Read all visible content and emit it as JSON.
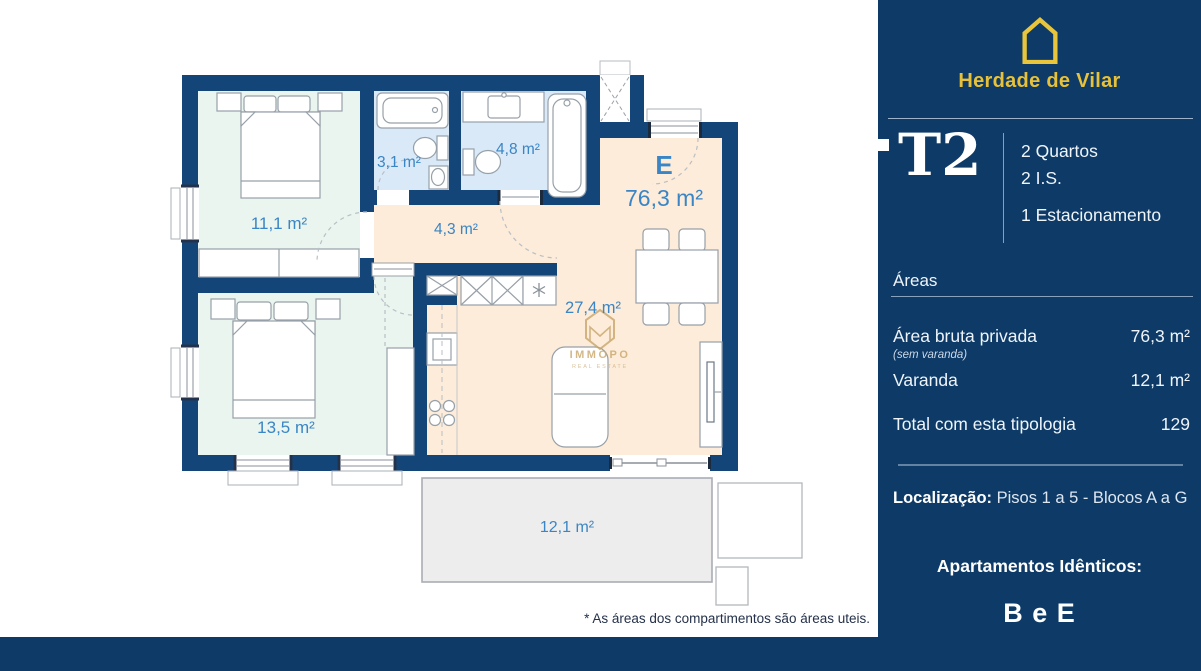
{
  "brand": {
    "name": "Herdade de Vilar"
  },
  "unit": {
    "type": "T2",
    "features": [
      "2 Quartos",
      "2 I.S.",
      "1 Estacionamento"
    ]
  },
  "areas": {
    "heading": "Áreas",
    "rows": [
      {
        "label": "Área bruta privada",
        "note": "(sem varanda)",
        "value": "76,3 m²"
      },
      {
        "label": "Varanda",
        "value": "12,1 m²"
      },
      {
        "label": "Total com esta tipologia",
        "value": "129"
      }
    ]
  },
  "location": {
    "label": "Localização:",
    "value": "Pisos 1 a 5 - Blocos A a G"
  },
  "identical": {
    "heading": "Apartamentos Idênticos:",
    "value": "B e E"
  },
  "plan": {
    "unit_letter": "E",
    "unit_area": "76,3 m²",
    "rooms": [
      {
        "name": "bedroom-1",
        "area": "11,1 m²"
      },
      {
        "name": "bathroom-1",
        "area": "3,1 m²"
      },
      {
        "name": "bathroom-2",
        "area": "4,8 m²"
      },
      {
        "name": "hall",
        "area": "4,3 m²"
      },
      {
        "name": "bedroom-2",
        "area": "13,5 m²"
      },
      {
        "name": "kitchen-living",
        "area": "27,4 m²"
      },
      {
        "name": "balcony",
        "area": "12,1 m²"
      }
    ],
    "watermark": {
      "line1": "IMMOPO",
      "line2": "REAL ESTATE"
    }
  },
  "footnote": "* As áreas dos compartimentos são áreas uteis.",
  "colors": {
    "panel_navy": "#0d3a66",
    "wall_navy": "#144579",
    "accent_yellow": "#e7c13a",
    "label_blue": "#3a85c5",
    "bedroom_green": "#e9f5ee",
    "bath_blue": "#d9e9f8",
    "floor_peach": "#fcecd9",
    "balcony_grey": "#ededed"
  }
}
